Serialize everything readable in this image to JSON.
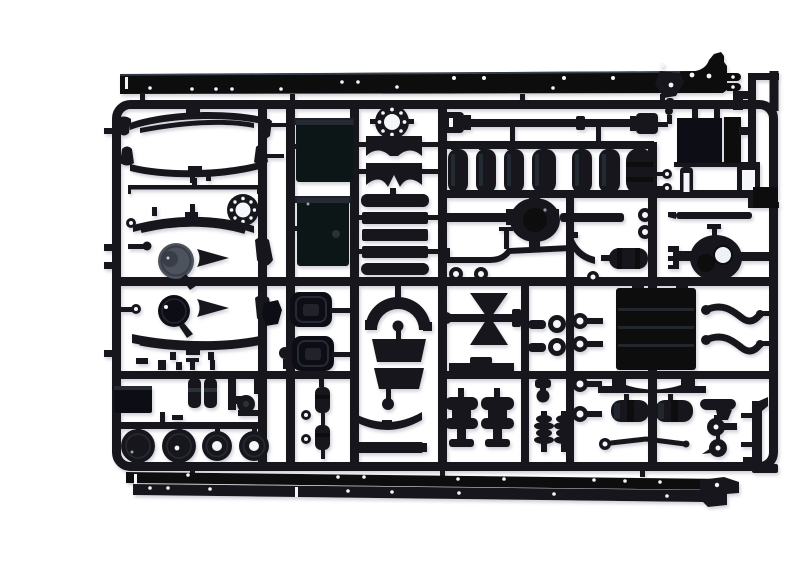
{
  "scene": {
    "type": "product-photograph",
    "subject": "Black injection-molded plastic sprue (parts tree) of a truck model kit chassis",
    "details": "Rectangular runner frame holding molded parts: long chassis frame rails, leaf springs, air tanks, fuel-tank halves, axle housings, wheel hubs, brake chambers and suspension hardware",
    "background": "plain white studio backdrop",
    "visible_text": "none"
  },
  "colors": {
    "background": "#ffffff",
    "plastic": "#16181e",
    "plastic_dark": "#0b0d11",
    "plastic_deep": "#07090c",
    "highlight": "#2b323e",
    "seam_light": "#d8dde6",
    "dust_gray": "#4d525c",
    "dust_gray_dark": "#383d46",
    "hole_white": "#f4f6f9",
    "shadow": "#8a90a0"
  },
  "parts": [
    {
      "name": "chassis-frame-rail",
      "count": 3
    },
    {
      "name": "leaf-spring",
      "count": 4
    },
    {
      "name": "spring-hanger",
      "count": 4
    },
    {
      "name": "axle-flange-ring",
      "count": 2
    },
    {
      "name": "fuel-tank-body",
      "count": 2
    },
    {
      "name": "fuel-tank-end-cap",
      "count": 2
    },
    {
      "name": "tank-shell-half",
      "count": 2
    },
    {
      "name": "ladder-frame",
      "count": 1
    },
    {
      "name": "driveshaft",
      "count": 1
    },
    {
      "name": "air-tank",
      "count": 6
    },
    {
      "name": "muffler",
      "count": 2
    },
    {
      "name": "battery-box",
      "count": 1
    },
    {
      "name": "pivot-bracket-with-chain",
      "count": 1
    },
    {
      "name": "rear-axle-housing",
      "count": 2
    },
    {
      "name": "front-axle-beam",
      "count": 1
    },
    {
      "name": "air-reservoir",
      "count": 2
    },
    {
      "name": "tie-rod",
      "count": 1
    },
    {
      "name": "torque-arm",
      "count": 2
    },
    {
      "name": "stabilizer-link",
      "count": 2
    },
    {
      "name": "o-ring",
      "count": 7
    },
    {
      "name": "brake-drum",
      "count": 2
    },
    {
      "name": "mud-deflector",
      "count": 2
    },
    {
      "name": "air-spring-bag",
      "count": 2
    },
    {
      "name": "wheel-hub",
      "count": 4
    },
    {
      "name": "shock-absorber",
      "count": 2
    },
    {
      "name": "brake-chamber",
      "count": 2
    },
    {
      "name": "coupling-spool",
      "count": 1
    },
    {
      "name": "wheel-arch",
      "count": 1
    },
    {
      "name": "bumper-strip",
      "count": 1
    },
    {
      "name": "cross-member",
      "count": 2
    },
    {
      "name": "radiator-plate",
      "count": 1
    },
    {
      "name": "cab-step",
      "count": 2
    },
    {
      "name": "valve-fitting",
      "count": 4
    },
    {
      "name": "eye-bolt",
      "count": 4
    },
    {
      "name": "steering-knuckle",
      "count": 3
    },
    {
      "name": "mounting-plate",
      "count": 2
    },
    {
      "name": "pulley-bracket",
      "count": 1
    },
    {
      "name": "small-cylinder",
      "count": 2
    }
  ]
}
